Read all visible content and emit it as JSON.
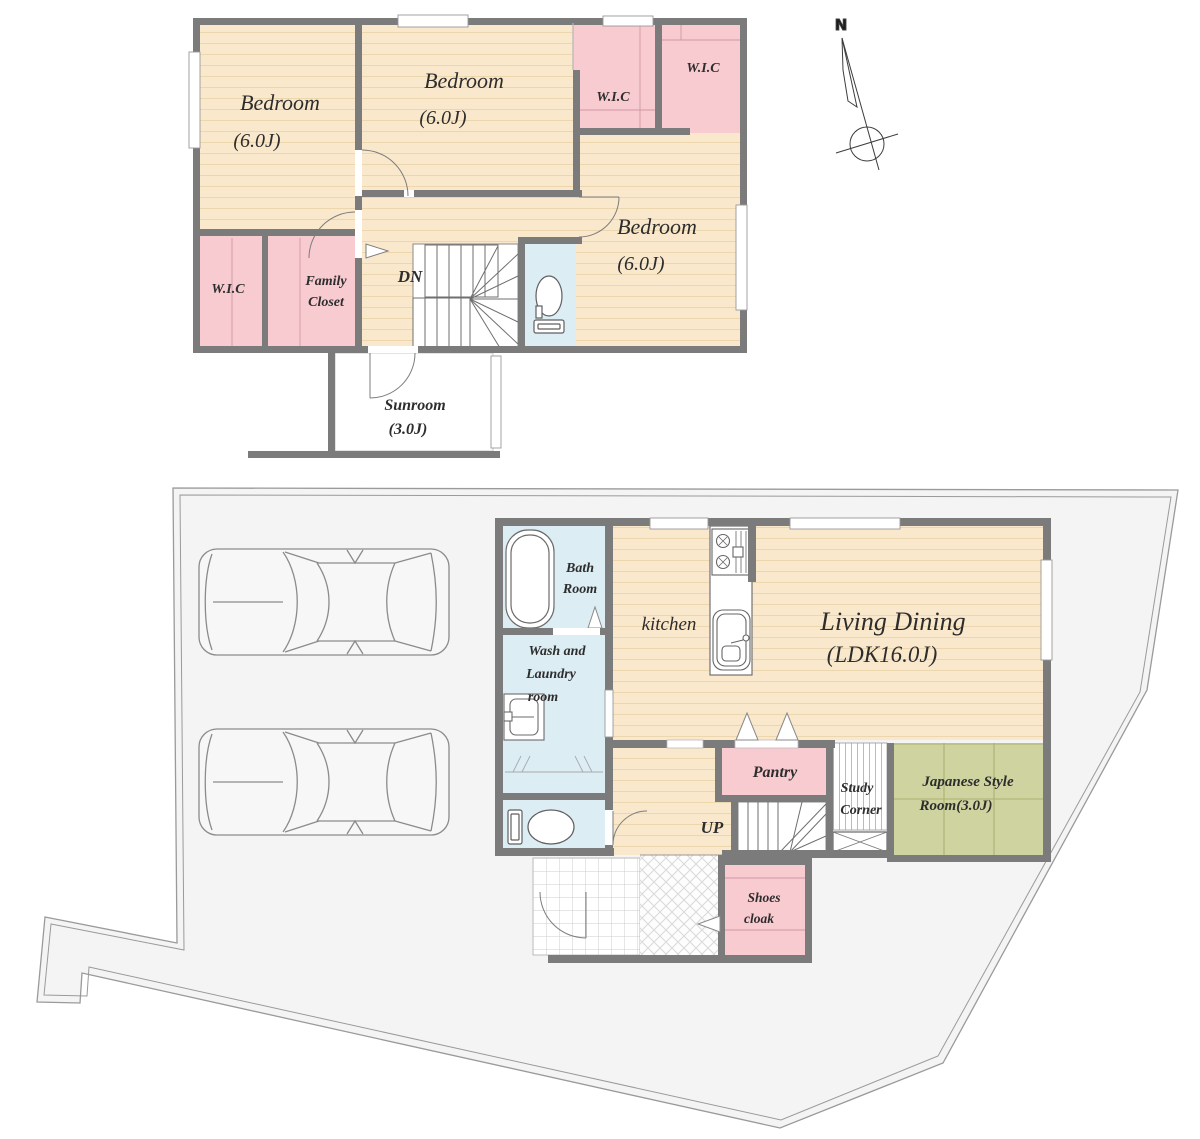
{
  "compass": {
    "label": "N"
  },
  "colors": {
    "wall": "#7b7b7b",
    "wood_floor": "#f9e8cb",
    "closet_pink": "#f8cbd1",
    "wet_area_blue": "#dcedf4",
    "tatami_green": "#ced39f",
    "site_gray": "#f4f4f5"
  },
  "icons": [
    "compass-north-icon",
    "car-icon",
    "bathtub-icon",
    "washing-machine-icon",
    "toilet-icon",
    "kitchen-sink-icon",
    "stove-icon"
  ],
  "floor2": {
    "bedroom_nw": {
      "name": "Bedroom",
      "size": "(6.0J)"
    },
    "bedroom_n": {
      "name": "Bedroom",
      "size": "(6.0J)"
    },
    "bedroom_e": {
      "name": "Bedroom",
      "size": "(6.0J)"
    },
    "wic_ne1": "W.I.C",
    "wic_ne2": "W.I.C",
    "wic_sw": "W.I.C",
    "family_closet": {
      "lines": [
        "Family",
        "Closet"
      ]
    },
    "stair_label": "DN",
    "sunroom": {
      "name": "Sunroom",
      "size": "(3.0J)"
    }
  },
  "floor1": {
    "bath": {
      "lines": [
        "Bath",
        "Room"
      ]
    },
    "wash": {
      "lines": [
        "Wash and",
        "Laundry",
        "room"
      ]
    },
    "kitchen": "kitchen",
    "living_dining": {
      "name": "Living Dining",
      "size": "(LDK16.0J)"
    },
    "pantry": "Pantry",
    "study": {
      "lines": [
        "Study",
        "Corner"
      ]
    },
    "japanese": {
      "lines": [
        "Japanese Style",
        "Room(3.0J)"
      ]
    },
    "stair_label": "UP",
    "shoes": {
      "lines": [
        "Shoes",
        "cloak"
      ]
    }
  }
}
